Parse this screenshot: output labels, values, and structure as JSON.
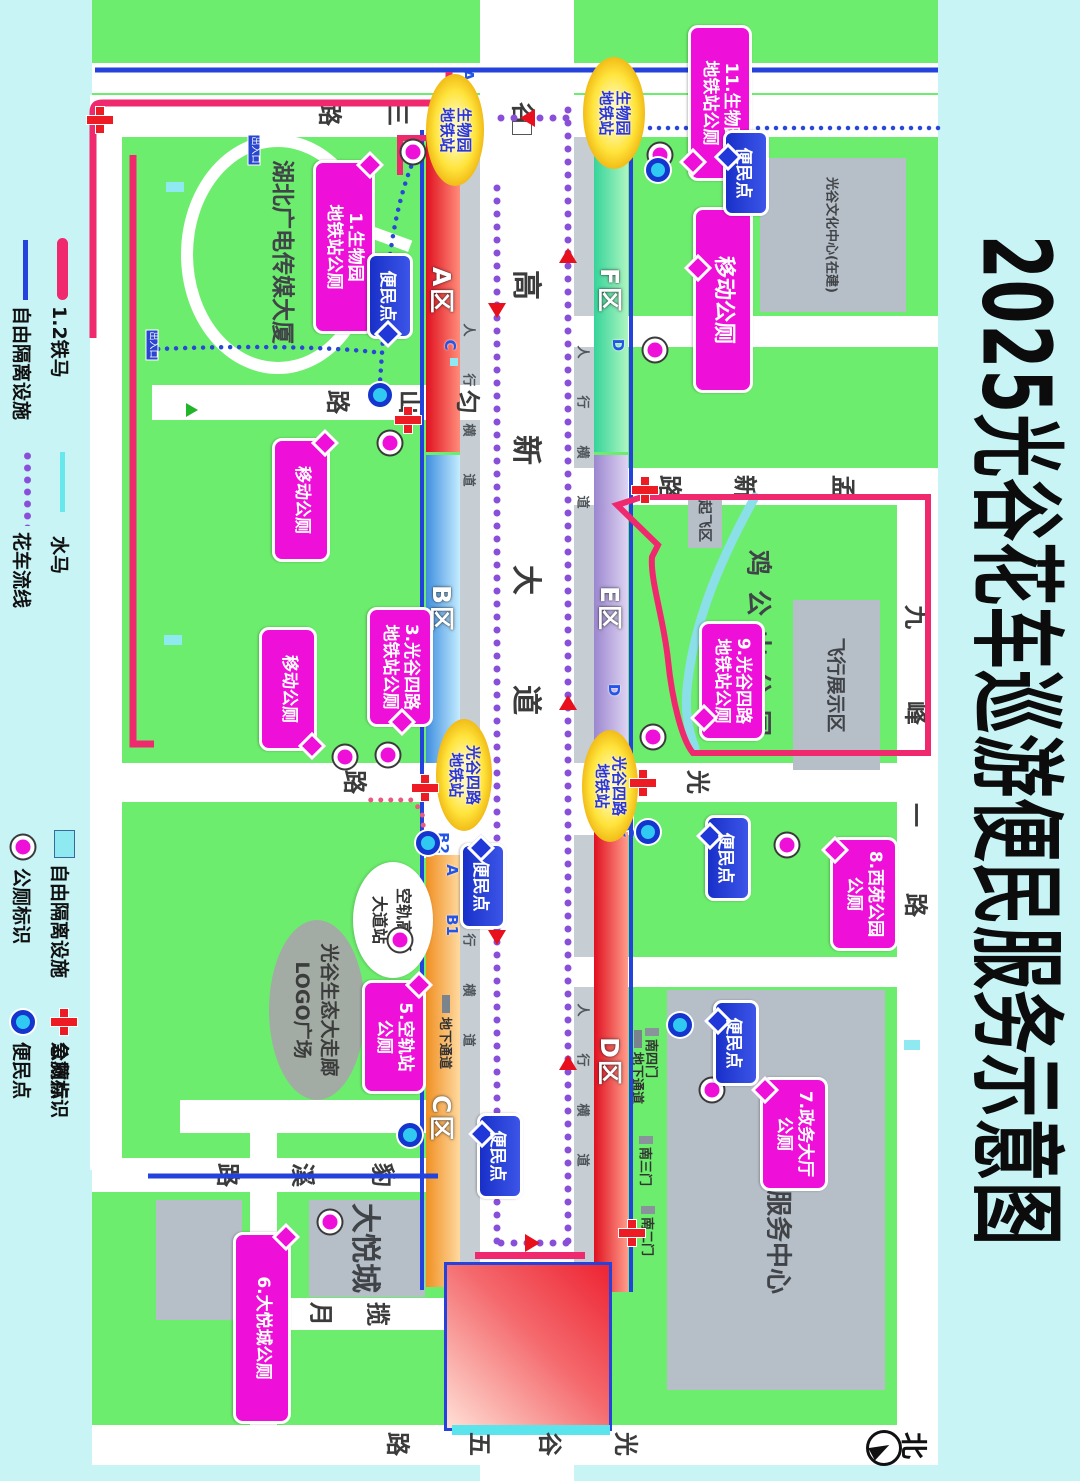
{
  "title": "2025光谷花车巡游便民服务示意图",
  "legend": {
    "items": [
      {
        "label": "1.2铁马",
        "symbol": "pink-line"
      },
      {
        "label": "水马",
        "symbol": "cyan-line"
      },
      {
        "label": "地铁站",
        "symbol": "cyan-rect"
      },
      {
        "label": "急救点",
        "symbol": "red-cross"
      },
      {
        "label": "自由隔离设施",
        "symbol": "blue-line"
      },
      {
        "label": "花车流线",
        "symbol": "purple-dotted-line"
      },
      {
        "label": "公厕标识",
        "symbol": "magenta-circle"
      },
      {
        "label": "便民点",
        "symbol": "blue-circle"
      }
    ]
  },
  "zones": {
    "a": "A区",
    "b": "B区",
    "c": "C区",
    "d": "D区",
    "e": "E区",
    "f": "F区"
  },
  "roads": {
    "gx3": "光谷三路",
    "gx4": "光谷四路",
    "gx5": "光谷五路",
    "gaoxin": "高新大道",
    "mengxin": "孟新路",
    "jiufeng": "九峰一路",
    "yunshan": "匀山路",
    "baoxi": "豹溪路",
    "lanyue": "揽月路"
  },
  "stations": {
    "swy1": "生物园",
    "swy2": "地铁站",
    "gg41": "光谷四路",
    "gg42": "地铁站"
  },
  "toilets": [
    {
      "l1": "1.生物园",
      "l2": "地铁站公厕"
    },
    {
      "l1": "移动公厕",
      "l2": ""
    },
    {
      "l1": "3.光谷四路",
      "l2": "地铁站公厕"
    },
    {
      "l1": "移动公厕",
      "l2": ""
    },
    {
      "l1": "5.空轨站",
      "l2": "公厕"
    },
    {
      "l1": "6.大悦城公厕",
      "l2": ""
    },
    {
      "l1": "移动公厕",
      "l2": ""
    },
    {
      "l1": "9.光谷四路",
      "l2": "地铁站公厕"
    },
    {
      "l1": "8.西苑公园",
      "l2": "公厕"
    },
    {
      "l1": "7.政务大厅",
      "l2": "公厕"
    },
    {
      "l1": "11.生物园",
      "l2": "地铁站公厕"
    }
  ],
  "conv_label": "便民点",
  "buildings": {
    "wenhua": "光谷文化中心(在建)",
    "fuwu": "光谷公共服务中心",
    "dayuecheng": "大悦城",
    "guangdian": "湖北广电传媒大厦",
    "feixing": "飞行展示区",
    "qifei": "起飞区",
    "jigongshan": "鸡公山公园",
    "logo1": "光谷生态大走廊",
    "logo2": "LOGO广场",
    "konggui1": "空轨高新",
    "konggui2": "大道站"
  },
  "gates": [
    "南四门",
    "南三门",
    "南二门"
  ],
  "exits": {
    "a": "A",
    "b1": "B1",
    "b2": "B2",
    "c": "C",
    "d": "D",
    "e": "E"
  },
  "misc": {
    "north": "北",
    "crosswalk": "人行横道",
    "underpass": "地下通道",
    "gate_tag": "出入口"
  },
  "colors": {
    "page": "#c8f4f6",
    "green": "#6ded6d",
    "road": "#ffffff",
    "gray_building": "#b6bec7",
    "barrier_pink": "#f0286e",
    "barrier_blue": "#2443dd",
    "water_cyan": "#6ee8ec",
    "route_purple": "#8a4fd8",
    "toilet_magenta": "#ee10d8",
    "aid_red": "#ed1c24",
    "conv_cyan": "#30c9f2",
    "station_yellow": "#ffe43c"
  }
}
